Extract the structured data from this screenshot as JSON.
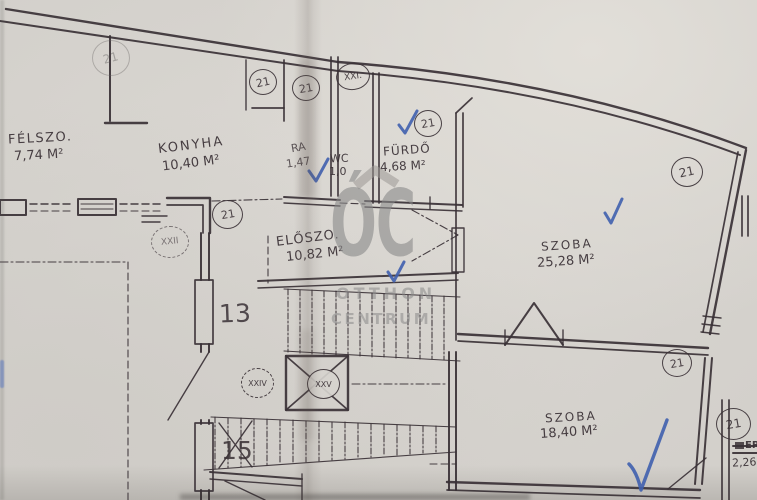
{
  "colors": {
    "ink": "#3a3136",
    "blue-ink": "#3f5fae",
    "paper": "#d7d4cf",
    "watermark": "#8a8a8a"
  },
  "watermark": {
    "monogram": "ÓC",
    "line1": "OTTHON",
    "line2": "CENTRUM"
  },
  "rooms": {
    "felszoba": {
      "label": "FÉLSZO.",
      "area": "7,74 M²"
    },
    "konyha": {
      "label": "KONYHA",
      "area": "10,40 M²"
    },
    "kamra": {
      "label": "RA",
      "area": "1,47"
    },
    "wc": {
      "label": "WC",
      "area": "1,0"
    },
    "furdo": {
      "label": "FÜRDŐ",
      "area": "4,68 M²"
    },
    "eloszoba": {
      "label": "ELŐSZO.",
      "area": "10,82 M²"
    },
    "szoba1": {
      "label": "SZOBA",
      "area": "25,28 M²"
    },
    "szoba2": {
      "label": "SZOBA",
      "area": "18,40 M²"
    },
    "erkely": {
      "label": "ERK.",
      "area": "2,26"
    }
  },
  "stair_numbers": {
    "upper": "13",
    "lower": "15"
  },
  "circled_marks": {
    "stamp": "21",
    "c1": "21",
    "c2": "21",
    "c3": "XXI.",
    "c4": "21",
    "c5": "21",
    "c6": "21",
    "c7": "XXII",
    "c8": "XXIV",
    "c9": "XXV",
    "c10": "21",
    "c11": "21"
  }
}
